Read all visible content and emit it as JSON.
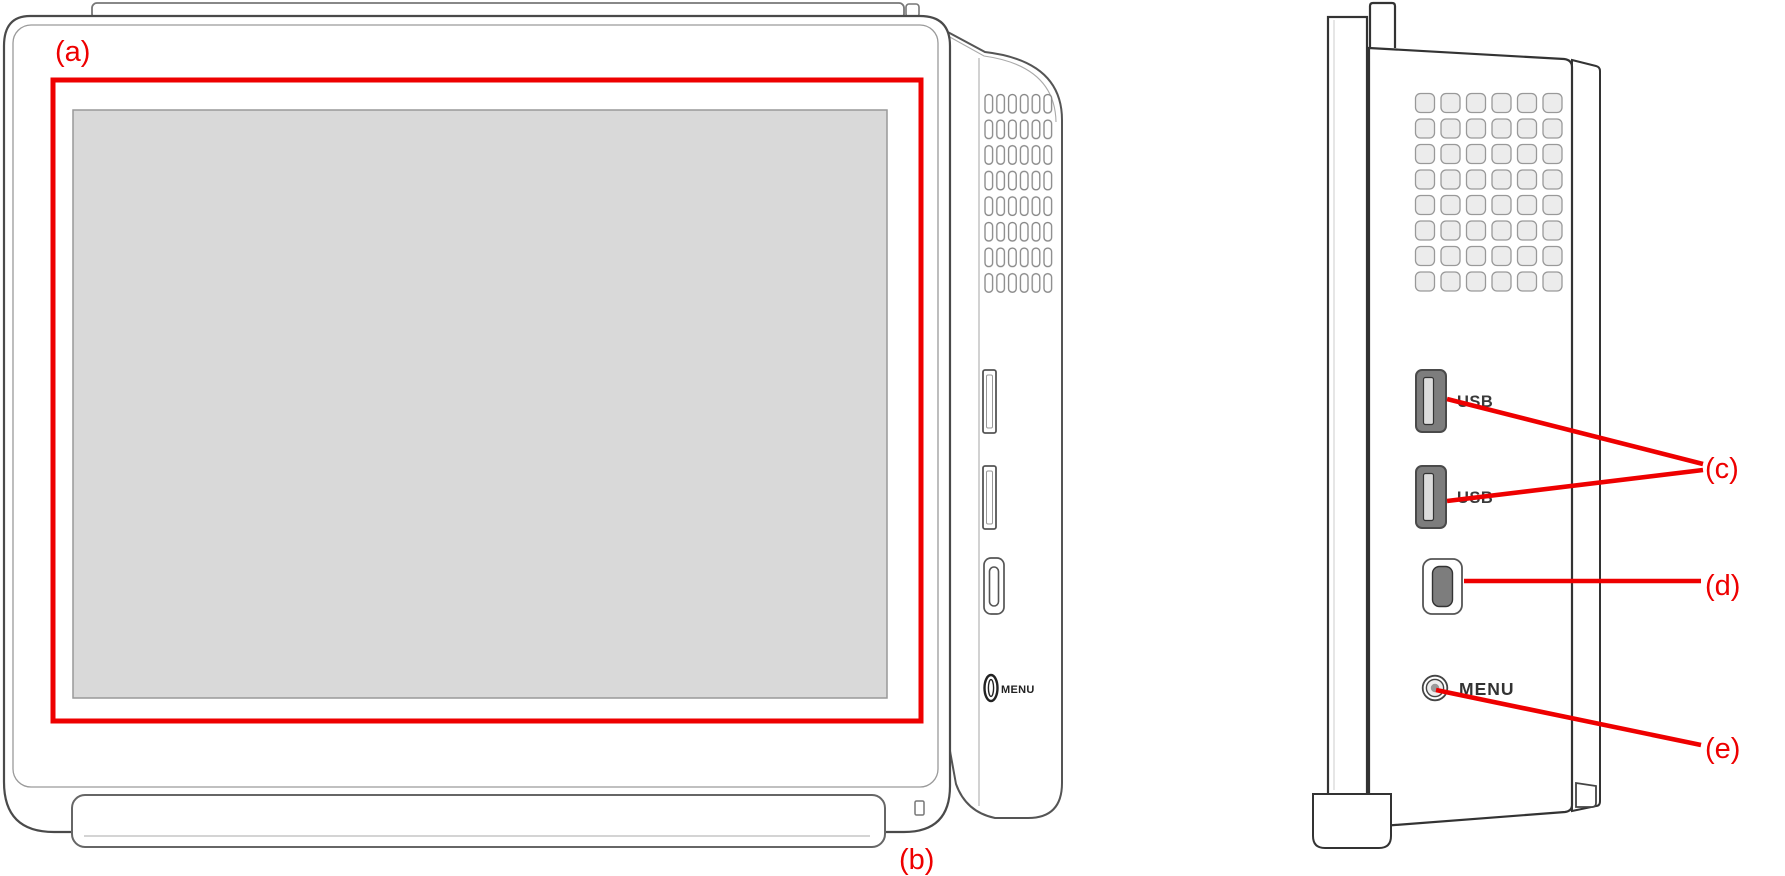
{
  "figure": {
    "type": "hardware-diagram",
    "callouts": {
      "a": "(a)",
      "b": "(b)",
      "c": "(c)",
      "d": "(d)",
      "e": "(e)"
    },
    "front_view": {
      "menu_button_label": "MENU"
    },
    "side_view": {
      "usb_port_top_label": "USB",
      "usb_port_bottom_label": "USB",
      "menu_button_label": "MENU"
    },
    "colors": {
      "annotation": "#ee0000",
      "screen_fill": "#d9d9d9",
      "usb_port_fill": "#7d7d7d",
      "vent_fill": "#ececec",
      "outline_front": "#4a4a4a",
      "outline_side": "#333333"
    }
  }
}
